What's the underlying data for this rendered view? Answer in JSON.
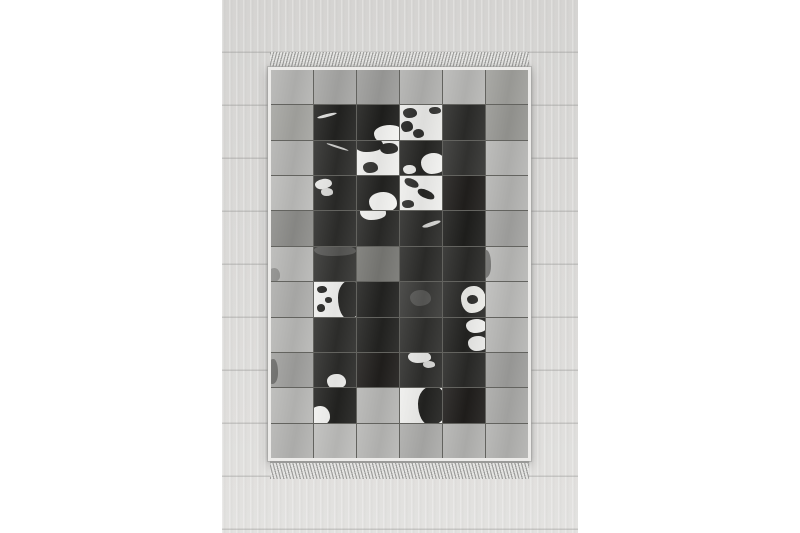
{
  "image": {
    "kind": "product-photo",
    "subject": "gray and black patchwork cowhide-style rug with fringed ends lying on a pale wood plank floor",
    "canvas_bg": "#ffffff"
  },
  "photo": {
    "wood_base": "#dcdbd9",
    "wood_dark": "#d5d4d2",
    "wood_light": "#e3e2e0",
    "plank_line": "#8c8c8a"
  },
  "rug": {
    "binding_color": "#ecebe9",
    "seam_color": "#63635f",
    "fringe_light": "#e4e4e2",
    "fringe_dark": "#9f9f9d",
    "fringe_band": "#9a9a98",
    "palette": {
      "gray_light": "#b8b8b6",
      "gray_medium": "#a3a3a1",
      "gray_dark": "#8d8d8a",
      "hide_black": "#211f1d",
      "hide_dark": "#2e2e2c",
      "hide_white": "#f0f0ee"
    },
    "grid": {
      "cols": 6,
      "rows": 11,
      "patches": [
        [
          {
            "bg": "#b5b5b3"
          },
          {
            "bg": "#a7a7a5"
          },
          {
            "bg": "#9c9c9a"
          },
          {
            "bg": "#b1b1af"
          },
          {
            "bg": "#b8b8b6"
          },
          {
            "bg": "#a0a09c"
          }
        ],
        [
          {
            "bg": "#a5a5a1"
          },
          {
            "bg": "#232321",
            "spots": [
              {
                "l": 8,
                "t": 26,
                "w": 48,
                "h": 9,
                "c": "#dededc",
                "r": -14
              }
            ]
          },
          {
            "bg": "#1f1f1d",
            "spots": [
              {
                "l": 40,
                "t": 58,
                "w": 75,
                "h": 55,
                "c": "#f3f3f1"
              }
            ]
          },
          {
            "bg": "#e9e9e7",
            "spots": [
              {
                "l": 6,
                "t": 8,
                "w": 34,
                "h": 30,
                "c": "#2b2b29"
              },
              {
                "l": 2,
                "t": 45,
                "w": 30,
                "h": 34,
                "c": "#232321"
              },
              {
                "l": 30,
                "t": 68,
                "w": 26,
                "h": 26,
                "c": "#2f2f2d"
              },
              {
                "l": 70,
                "t": 4,
                "w": 28,
                "h": 22,
                "c": "#343432"
              }
            ]
          },
          {
            "bg": "#2c2c2a"
          },
          {
            "bg": "#979793"
          }
        ],
        [
          {
            "bg": "#b3b3b1"
          },
          {
            "bg": "#2e2e2c",
            "spots": [
              {
                "l": 28,
                "t": 16,
                "w": 55,
                "h": 7,
                "c": "#cfcfcd",
                "r": 18
              }
            ]
          },
          {
            "bg": "#efefed",
            "spots": [
              {
                "l": -8,
                "t": -12,
                "w": 70,
                "h": 45,
                "c": "#242422"
              },
              {
                "l": 55,
                "t": 8,
                "w": 42,
                "h": 30,
                "c": "#2a2a28"
              },
              {
                "l": 15,
                "t": 62,
                "w": 35,
                "h": 32,
                "c": "#343432"
              }
            ]
          },
          {
            "bg": "#262624",
            "spots": [
              {
                "l": 50,
                "t": 35,
                "w": 60,
                "h": 62,
                "c": "#f1f1ef"
              },
              {
                "l": 8,
                "t": 70,
                "w": 30,
                "h": 28,
                "c": "#e9e9e7"
              }
            ]
          },
          {
            "bg": "#343432"
          },
          {
            "bg": "#b6b6b4"
          }
        ],
        [
          {
            "bg": "#bcbcba"
          },
          {
            "bg": "#2a2a28",
            "spots": [
              {
                "l": 2,
                "t": 8,
                "w": 40,
                "h": 30,
                "c": "#e6e6e4",
                "r": -10
              },
              {
                "l": 16,
                "t": 36,
                "w": 30,
                "h": 22,
                "c": "#d8d8d6"
              }
            ]
          },
          {
            "bg": "#232321",
            "spots": [
              {
                "l": 28,
                "t": 45,
                "w": 68,
                "h": 62,
                "c": "#f4f4f2"
              }
            ]
          },
          {
            "bg": "#eeeeec",
            "spots": [
              {
                "l": 10,
                "t": 8,
                "w": 36,
                "h": 24,
                "c": "#2c2c2a",
                "r": 24
              },
              {
                "l": 40,
                "t": 40,
                "w": 42,
                "h": 24,
                "c": "#262624",
                "r": 24
              },
              {
                "l": 4,
                "t": 70,
                "w": 30,
                "h": 22,
                "c": "#30302e"
              }
            ]
          },
          {
            "bg": "#211f1d"
          },
          {
            "bg": "#b4b4b2"
          }
        ],
        [
          {
            "bg": "#8d8d8a"
          },
          {
            "bg": "#2d2d2b"
          },
          {
            "bg": "#2a2a28",
            "spots": [
              {
                "l": 8,
                "t": -18,
                "w": 60,
                "h": 42,
                "c": "#efefed"
              }
            ]
          },
          {
            "bg": "#2c2c2a",
            "spots": [
              {
                "l": 52,
                "t": 30,
                "w": 46,
                "h": 13,
                "c": "#d4d4d2",
                "r": -18
              }
            ]
          },
          {
            "bg": "#1f1f1d"
          },
          {
            "bg": "#a3a3a1"
          }
        ],
        [
          {
            "bg": "#b8b8b6",
            "spots": [
              {
                "l": -8,
                "t": 62,
                "w": 30,
                "h": 40,
                "c": "#8f8f8d"
              }
            ]
          },
          {
            "bg": "#343432",
            "spots": [
              {
                "l": 0,
                "t": -6,
                "w": 100,
                "h": 34,
                "c": "#565654"
              }
            ]
          },
          {
            "bg": "#787874"
          },
          {
            "bg": "#2c2c2a"
          },
          {
            "bg": "#2a2a28"
          },
          {
            "bg": "#b8b8b6",
            "spots": [
              {
                "l": -12,
                "t": 10,
                "w": 25,
                "h": 80,
                "c": "#6f6f6d"
              }
            ]
          }
        ],
        [
          {
            "bg": "#aeaeac"
          },
          {
            "bg": "#f0f0ee",
            "spots": [
              {
                "l": 56,
                "t": -6,
                "w": 58,
                "h": 112,
                "c": "#2a2a28"
              },
              {
                "l": 8,
                "t": 12,
                "w": 22,
                "h": 20,
                "c": "#232321"
              },
              {
                "l": 26,
                "t": 44,
                "w": 18,
                "h": 16,
                "c": "#2e2e2c"
              },
              {
                "l": 6,
                "t": 64,
                "w": 20,
                "h": 22,
                "c": "#262624"
              }
            ]
          },
          {
            "bg": "#232321"
          },
          {
            "bg": "#3a3a38",
            "spots": [
              {
                "l": 24,
                "t": 24,
                "w": 50,
                "h": 46,
                "c": "#575755"
              }
            ]
          },
          {
            "bg": "#2a2a28",
            "spots": [
              {
                "l": 44,
                "t": 12,
                "w": 58,
                "h": 78,
                "c": "#ecece8"
              },
              {
                "l": 58,
                "t": 38,
                "w": 26,
                "h": 26,
                "c": "#2e2e2c"
              }
            ]
          },
          {
            "bg": "#bcbcba"
          }
        ],
        [
          {
            "bg": "#b8b8b6"
          },
          {
            "bg": "#2e2e2c"
          },
          {
            "bg": "#232321"
          },
          {
            "bg": "#30302e"
          },
          {
            "bg": "#232321",
            "spots": [
              {
                "l": 55,
                "t": 4,
                "w": 50,
                "h": 40,
                "c": "#f0f0ee"
              },
              {
                "l": 60,
                "t": 54,
                "w": 46,
                "h": 42,
                "c": "#e8e8e6"
              }
            ]
          },
          {
            "bg": "#b6b6b4"
          }
        ],
        [
          {
            "bg": "#a0a09e",
            "spots": [
              {
                "l": -6,
                "t": 18,
                "w": 22,
                "h": 72,
                "c": "#6a6a68"
              }
            ]
          },
          {
            "bg": "#2c2c2a",
            "spots": [
              {
                "l": 30,
                "t": 60,
                "w": 46,
                "h": 46,
                "c": "#eeeeec"
              }
            ]
          },
          {
            "bg": "#211f1d"
          },
          {
            "bg": "#2e2e2c",
            "spots": [
              {
                "l": 18,
                "t": -6,
                "w": 56,
                "h": 34,
                "c": "#e6e6e4"
              },
              {
                "l": 54,
                "t": 24,
                "w": 30,
                "h": 20,
                "c": "#d8d8d6"
              }
            ]
          },
          {
            "bg": "#2a2a28"
          },
          {
            "bg": "#9e9e9c"
          }
        ],
        [
          {
            "bg": "#b9b9b7"
          },
          {
            "bg": "#232321",
            "spots": [
              {
                "l": -10,
                "t": 52,
                "w": 48,
                "h": 58,
                "c": "#f2f2f0"
              }
            ]
          },
          {
            "bg": "#b6b6b4"
          },
          {
            "bg": "#eeeeec",
            "spots": [
              {
                "l": 44,
                "t": -8,
                "w": 68,
                "h": 116,
                "c": "#232321"
              }
            ]
          },
          {
            "bg": "#201e1c"
          },
          {
            "bg": "#a9a9a7"
          }
        ],
        [
          {
            "bg": "#b4b4b2"
          },
          {
            "bg": "#bdbdbb"
          },
          {
            "bg": "#b7b7b5"
          },
          {
            "bg": "#ababa9"
          },
          {
            "bg": "#b3b3b1"
          },
          {
            "bg": "#b3b3b1"
          }
        ]
      ]
    }
  }
}
